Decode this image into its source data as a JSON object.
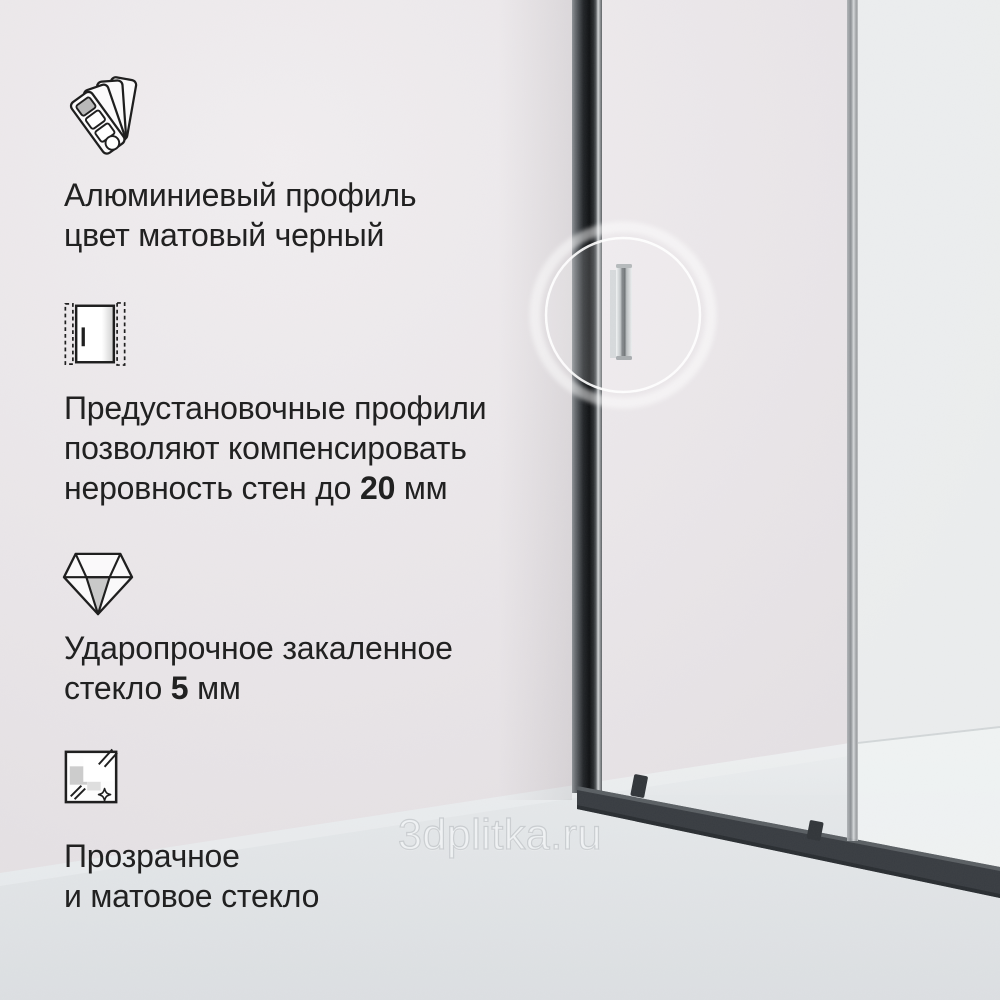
{
  "page": {
    "type": "product-feature-card",
    "language": "ru",
    "subject": "shower-enclosure-sliding-door"
  },
  "colors": {
    "wall": "#e9e5e8",
    "floor": "#e2e5e7",
    "profile_matte_black": "#17191c",
    "bottom_rail": "#3a3e43",
    "chrome_handle": "#c7cbcd",
    "text": "#212121",
    "highlight_ring": "#ffffff"
  },
  "features": [
    {
      "icon": "color-swatches-icon",
      "lines": [
        [
          {
            "t": "Алюминиевый профиль"
          }
        ],
        [
          {
            "t": "цвет матовый черный"
          }
        ]
      ]
    },
    {
      "icon": "preinstall-profile-icon",
      "lines": [
        [
          {
            "t": "Предустановочные профили"
          }
        ],
        [
          {
            "t": "позволяют компенсировать"
          }
        ],
        [
          {
            "t": "неровность стен до "
          },
          {
            "t": "20",
            "b": true
          },
          {
            "t": " мм"
          }
        ]
      ]
    },
    {
      "icon": "tempered-glass-diamond-icon",
      "lines": [
        [
          {
            "t": "Ударопрочное закаленное"
          }
        ],
        [
          {
            "t": "стекло "
          },
          {
            "t": "5",
            "b": true
          },
          {
            "t": " мм"
          }
        ]
      ]
    },
    {
      "icon": "glass-finish-icon",
      "lines": [
        [
          {
            "t": "Прозрачное"
          }
        ],
        [
          {
            "t": "и матовое стекло"
          }
        ]
      ]
    }
  ],
  "watermark": {
    "text": "3dplitka.ru"
  }
}
